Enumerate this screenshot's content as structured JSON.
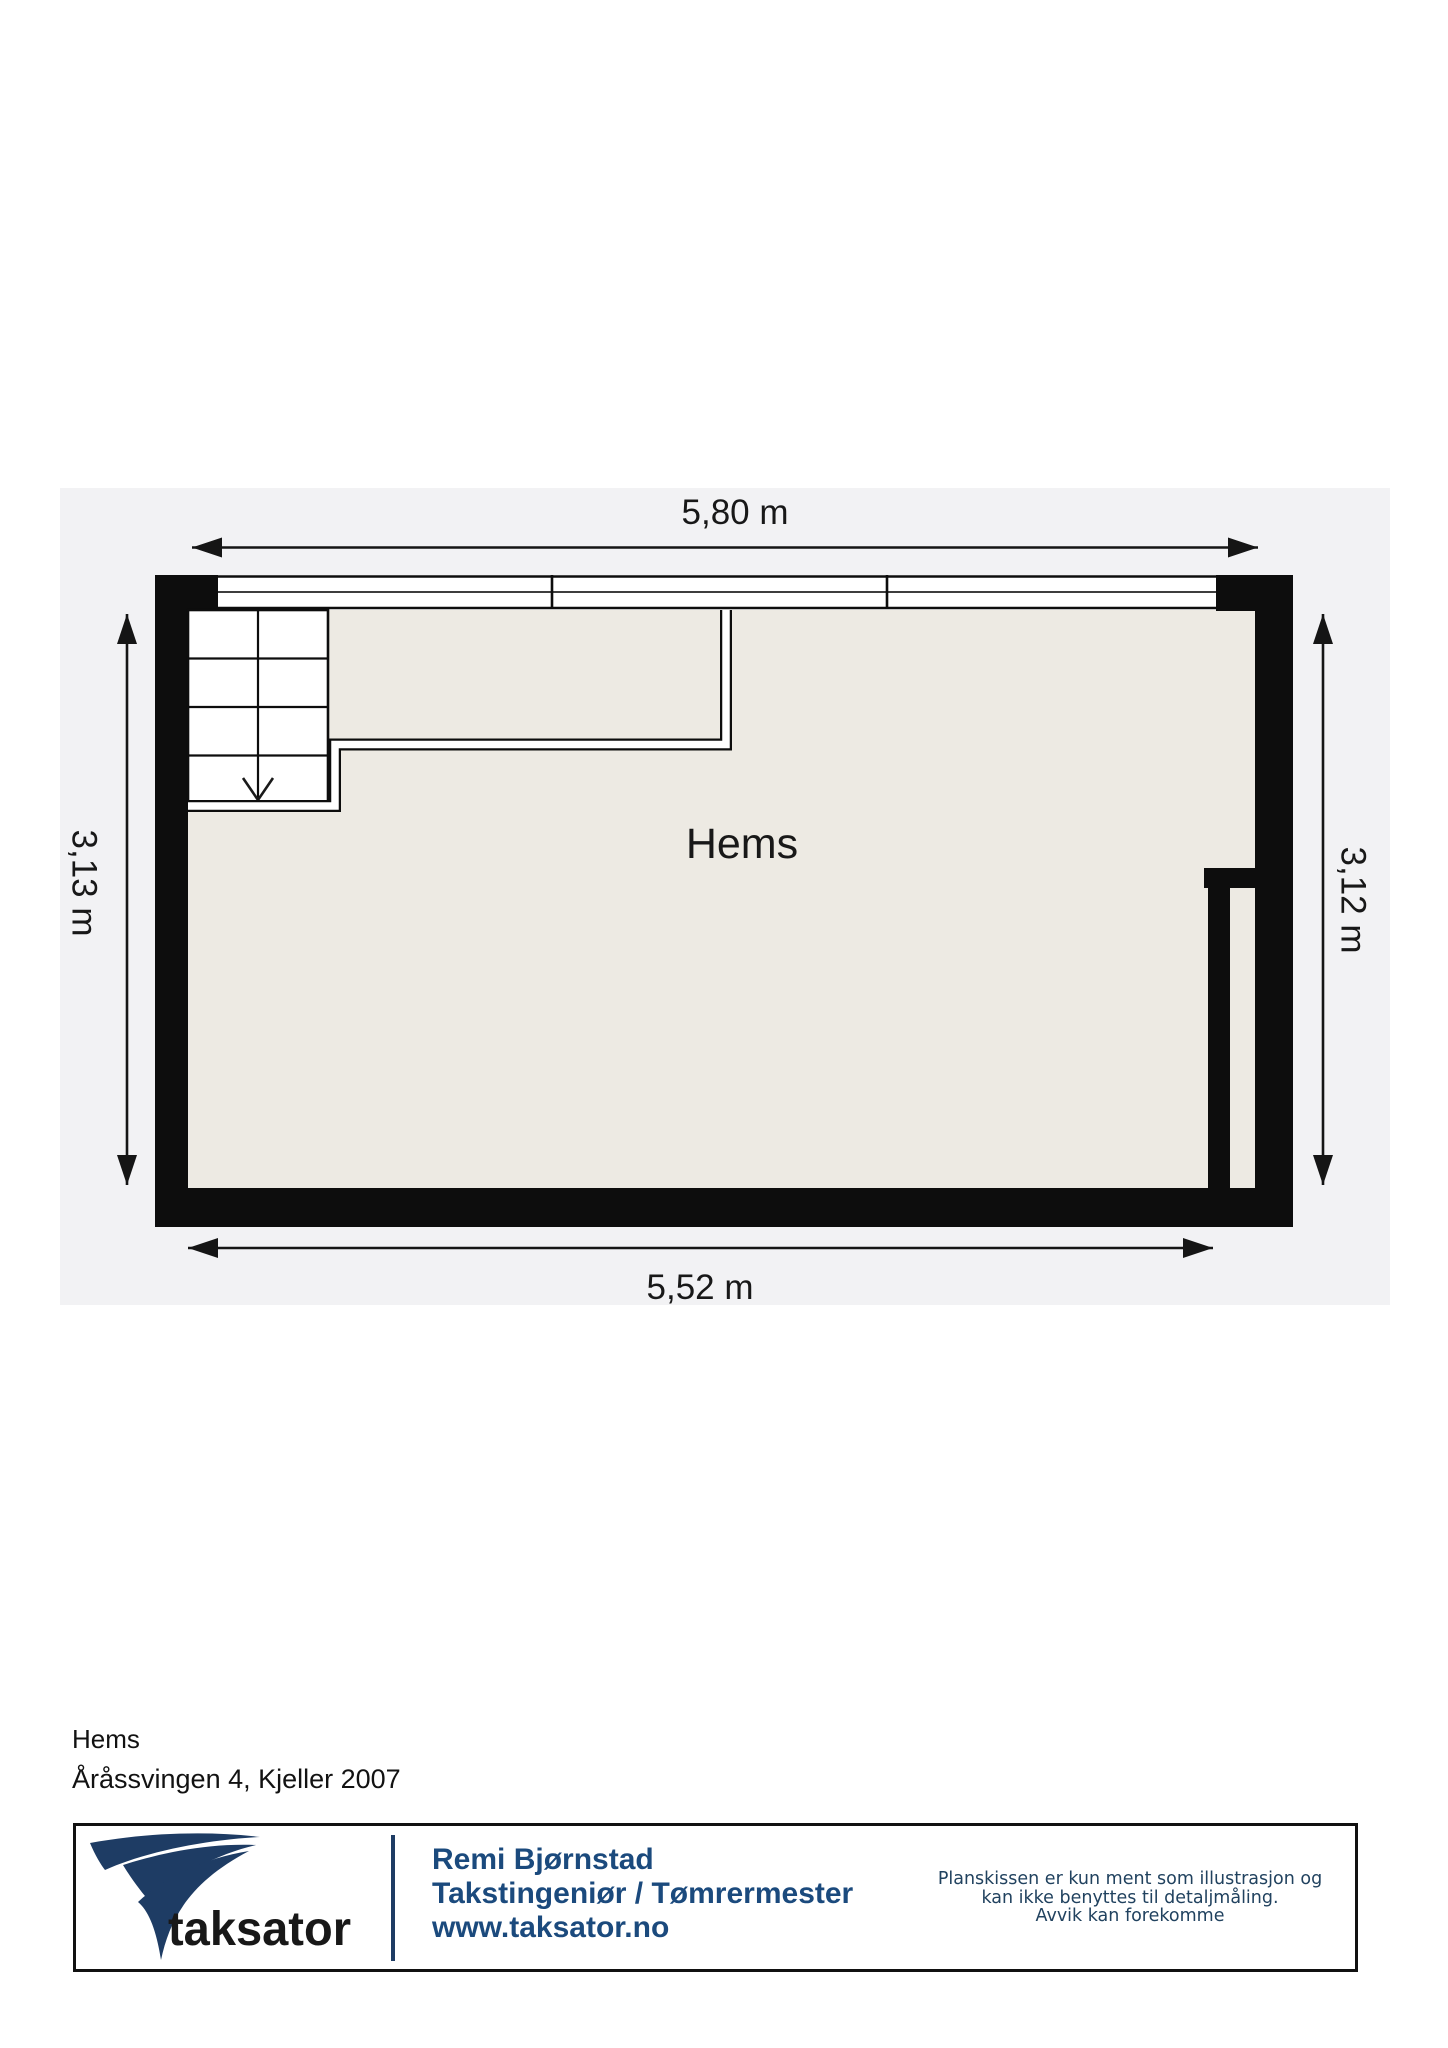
{
  "plan": {
    "room_label": "Hems",
    "dim_top": "5,80 m",
    "dim_bottom": "5,52 m",
    "dim_left": "3,13 m",
    "dim_right": "3,12 m"
  },
  "caption": {
    "floor": "Hems",
    "address": "Åråssvingen 4, Kjeller 2007"
  },
  "footer": {
    "brand": "taksator",
    "name": "Remi Bjørnstad",
    "role": "Takstingeniør / Tømrermester",
    "website": "www.taksator.no",
    "disclaimer1": "Planskissen er kun ment som illustrasjon og",
    "disclaimer2": "kan ikke benyttes til detaljmåling.",
    "disclaimer3": "Avvik kan forekomme"
  },
  "colors": {
    "wall": "#0d0d0d",
    "floor_fill": "#edeae3",
    "panel": "#f2f2f4",
    "navy": "#1e3c64",
    "contact_text": "#1b4a7d",
    "disclaimer_text": "#21425f",
    "brand_gray": "#8a8a8a"
  }
}
